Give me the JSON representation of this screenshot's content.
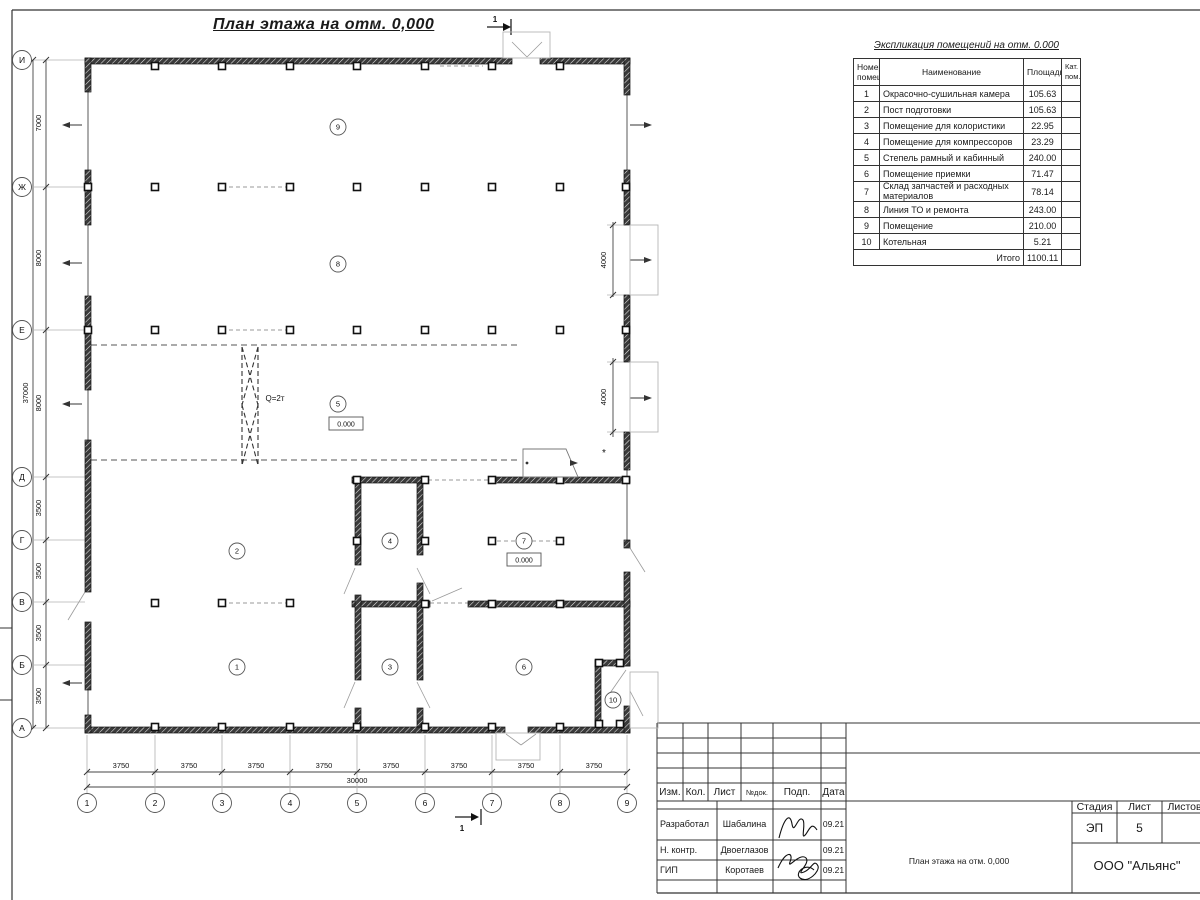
{
  "colors": {
    "line": "#333333",
    "wall": "#3a3a3a",
    "light_gray": "#b5b5b5"
  },
  "plan": {
    "title": "План этажа на отм. 0,000",
    "axes_v": [
      "И",
      "Ж",
      "Е",
      "Д",
      "Г",
      "В",
      "Б",
      "А"
    ],
    "axes_h": [
      "1",
      "2",
      "3",
      "4",
      "5",
      "6",
      "7",
      "8",
      "9"
    ],
    "dims_v": [
      "7000",
      "8000",
      "8000",
      "3500",
      "3500",
      "3500",
      "3500"
    ],
    "dims_v_total": "37000",
    "dims_h": [
      "3750",
      "3750",
      "3750",
      "3750",
      "3750",
      "3750",
      "3750",
      "3750"
    ],
    "dims_h_total": "30000",
    "dims_right": [
      "4000",
      "4000"
    ],
    "rooms": [
      "1",
      "2",
      "3",
      "4",
      "5",
      "6",
      "7",
      "8",
      "9",
      "10"
    ],
    "crane_label": "Q=2т",
    "level_mark": "0.000",
    "section_mark": "1",
    "asterisk": "*"
  },
  "schedule": {
    "title": "Экспликация помещений на отм. 0.000",
    "headers": {
      "num": "Номер помещ.",
      "name": "Наименование",
      "area": "Площадь",
      "cat": "Кат. пом."
    },
    "rows": [
      {
        "num": "1",
        "name": "Окрасочно-сушильная камера",
        "area": "105.63"
      },
      {
        "num": "2",
        "name": "Пост подготовки",
        "area": "105.63"
      },
      {
        "num": "3",
        "name": "Помещение для колористики",
        "area": "22.95"
      },
      {
        "num": "4",
        "name": "Помещение для компрессоров",
        "area": "23.29"
      },
      {
        "num": "5",
        "name": "Степель рамный и кабинный",
        "area": "240.00"
      },
      {
        "num": "6",
        "name": "Помещение приемки",
        "area": "71.47"
      },
      {
        "num": "7",
        "name": "Склад запчастей и расходных материалов",
        "area": "78.14"
      },
      {
        "num": "8",
        "name": "Линия ТО и ремонта",
        "area": "243.00"
      },
      {
        "num": "9",
        "name": "Помещение",
        "area": "210.00"
      },
      {
        "num": "10",
        "name": "Котельная",
        "area": "5.21"
      }
    ],
    "total_label": "Итого",
    "total_value": "1100.11"
  },
  "title_block": {
    "rev_headers": [
      "Изм.",
      "Кол.",
      "Лист",
      "№док.",
      "Подп.",
      "Дата"
    ],
    "sign_rows": [
      {
        "role": "Разработал",
        "name": "Шабалина",
        "date": "09.21"
      },
      {
        "role": "Н. контр.",
        "name": "Двоеглазов",
        "date": "09.21"
      },
      {
        "role": "ГИП",
        "name": "Коротаев",
        "date": "09.21"
      }
    ],
    "stage_label": "Стадия",
    "stage": "ЭП",
    "sheet_label": "Лист",
    "sheet_no": "5",
    "sheets_label": "Листов",
    "doc_title": "План этажа на отм. 0,000",
    "company": "ООО \"Альянс\""
  }
}
